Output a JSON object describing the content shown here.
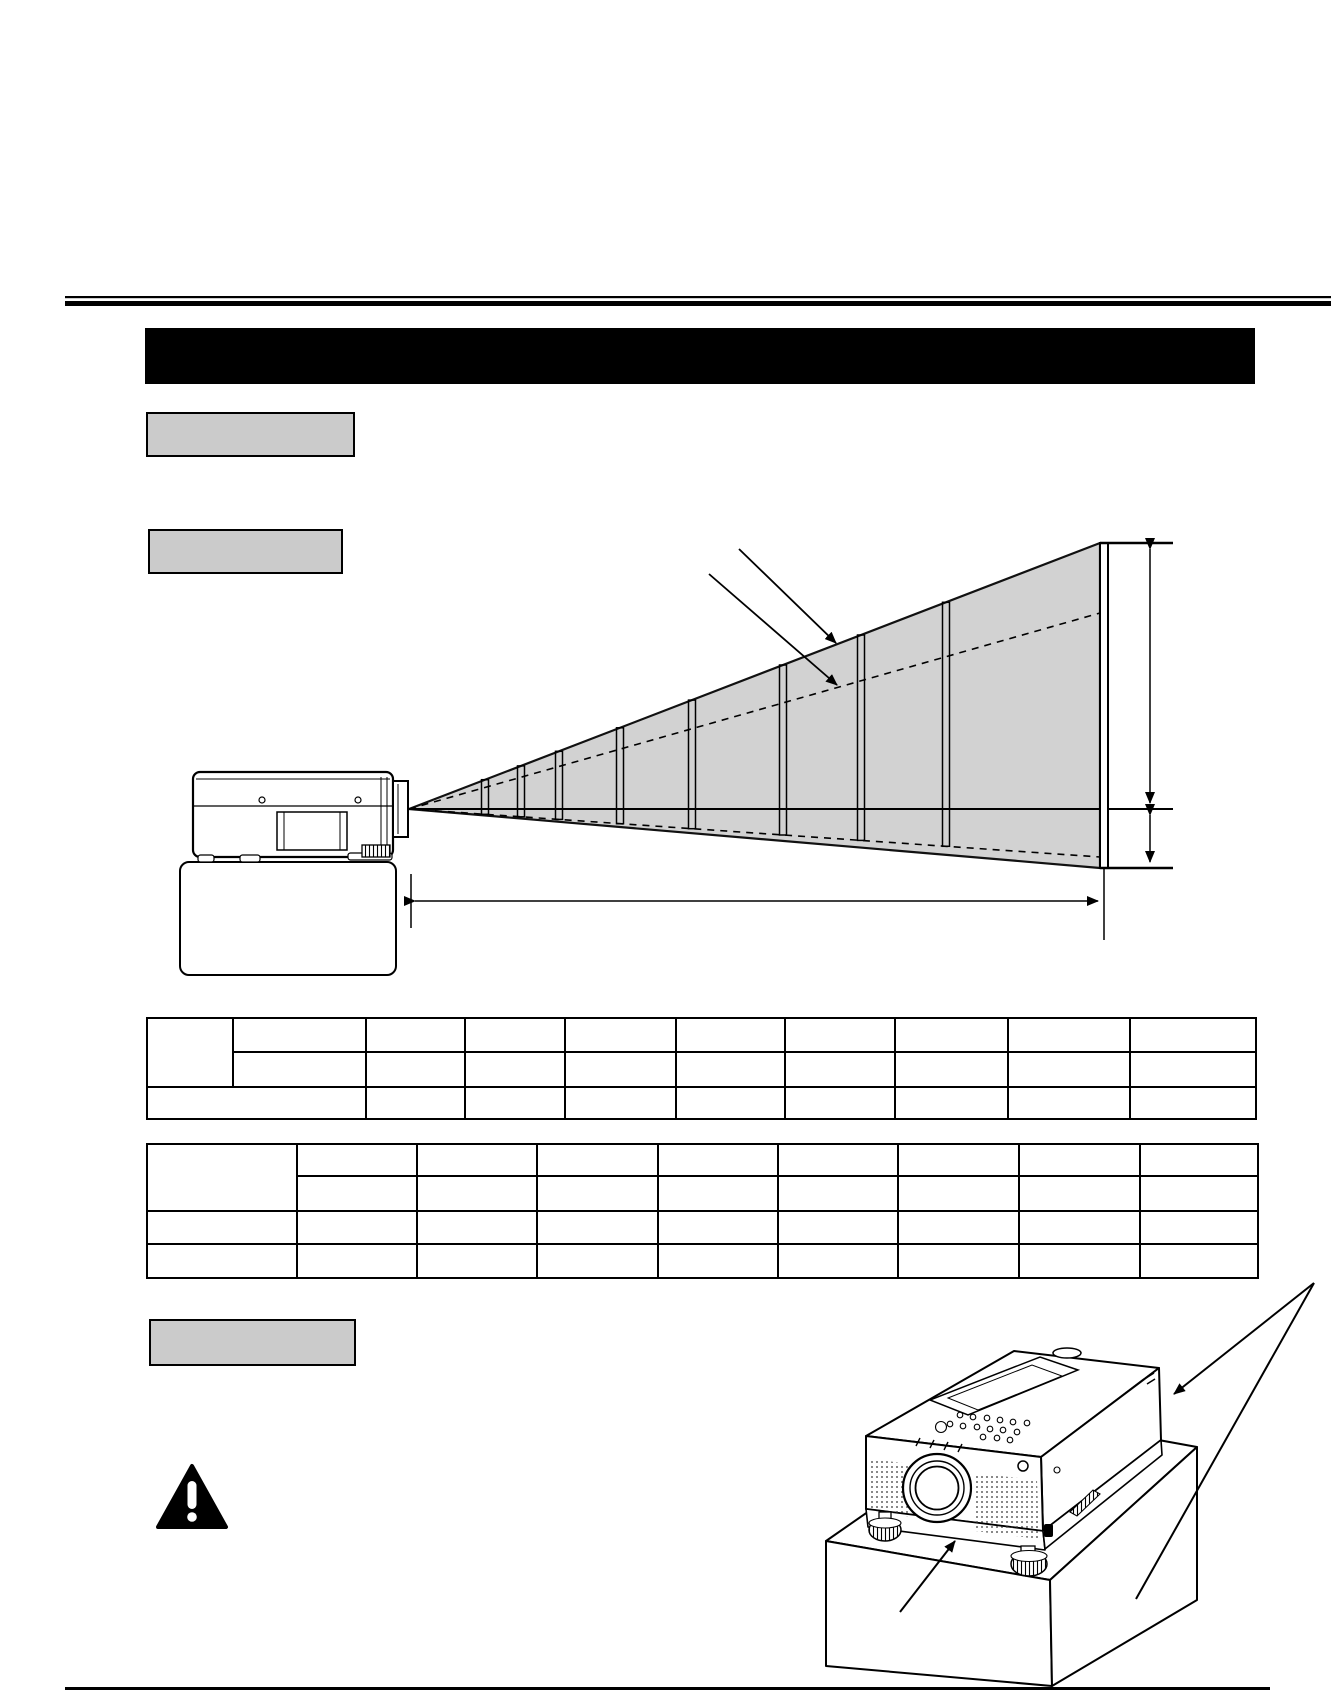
{
  "page": {
    "kind": "scanned-projector-manual-page",
    "background": "#ffffff",
    "ink_color": "#000000",
    "cone_fill": "#d2d2d2",
    "label_box_fill": "#cbcbcb",
    "title_bar_fill": "#000000"
  },
  "header": {
    "rule_style": "double",
    "title_bar_label": ""
  },
  "section_labels": {
    "first": "",
    "second": "",
    "third": ""
  },
  "diagram": {
    "type": "projection-distance-side-view",
    "screen_position_bars": 8,
    "has_dashed_min_zoom_lines": true,
    "annotations": {
      "screen_pointer_label": "",
      "axis_pointer_label": "",
      "screen_height_above_axis_label": "",
      "screen_height_below_axis_label": "",
      "throw_distance_label": ""
    }
  },
  "tables": {
    "table1": {
      "rows": 3,
      "columns": 10,
      "merged": [
        "r1c1 spans 2 rows",
        "r3c1 spans 2 columns"
      ],
      "cells": [
        [
          "",
          "",
          "",
          "",
          "",
          "",
          "",
          "",
          "",
          ""
        ],
        [
          "",
          "",
          "",
          "",
          "",
          "",
          "",
          "",
          ""
        ],
        [
          "",
          "",
          "",
          "",
          "",
          "",
          "",
          "",
          ""
        ]
      ]
    },
    "table2": {
      "rows": 4,
      "columns": 9,
      "merged": [
        "r1c1 spans 2 rows"
      ],
      "cells": [
        [
          "",
          "",
          "",
          "",
          "",
          "",
          "",
          "",
          ""
        ],
        [
          "",
          "",
          "",
          "",
          "",
          "",
          "",
          ""
        ],
        [
          "",
          "",
          "",
          "",
          "",
          "",
          "",
          "",
          ""
        ],
        [
          "",
          "",
          "",
          "",
          "",
          "",
          "",
          "",
          ""
        ]
      ]
    }
  },
  "warning": {
    "icon": "warning-triangle",
    "note_text": ""
  },
  "illustration": {
    "type": "projector-3d-on-table-corner",
    "pointer_labels": [
      "",
      ""
    ]
  }
}
